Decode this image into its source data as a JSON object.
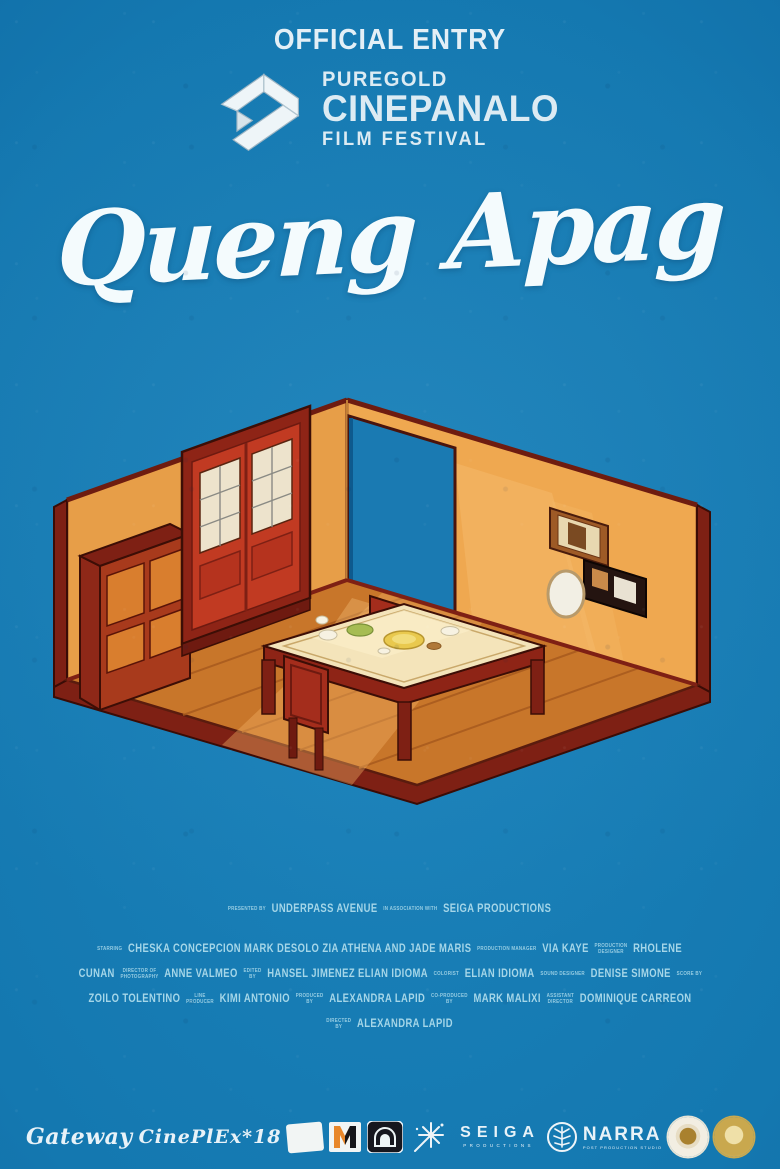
{
  "poster": {
    "official_entry": "OFFICIAL ENTRY",
    "festival": {
      "brand": "PUREGOLD",
      "name": "CINEPANALO",
      "subtitle": "FILM FESTIVAL",
      "icon": "impossible-ribbon-play-icon"
    },
    "title": "Queng Apag",
    "palette": {
      "background_blue": "#1478b0",
      "wall_orange": "#eda44c",
      "floor_wood": "#c8762a",
      "trim_maroon": "#7e2014",
      "door_red": "#c13a22",
      "doorway_blue": "#1a7ab2",
      "headline_text": "#e3eff6",
      "credits_text": "#a5d6e8"
    },
    "illustration_description": "Isometric cutaway dining room: orange walls, wooden plank floor, red double door with white window panes, tall cabinet, dining table set with food, two red chairs, open blue doorway, two wall frames and an oval mirror"
  },
  "credits": {
    "lines": [
      {
        "segments": [
          {
            "role": [
              "PRESENTED BY"
            ]
          },
          {
            "name": "UNDERPASS AVENUE"
          },
          {
            "role": [
              "IN ASSOCIATION WITH"
            ]
          },
          {
            "name": "SEIGA PRODUCTIONS"
          }
        ]
      },
      {
        "segments": [
          {
            "role": [
              "STARRING"
            ]
          },
          {
            "name": "CHESKA CONCEPCION MARK DESOLO ZIA ATHENA AND JADE MARIS"
          },
          {
            "role": [
              "PRODUCTION MANAGER"
            ]
          },
          {
            "name": "VIA KAYE"
          },
          {
            "role": [
              "PRODUCTION",
              "DESIGNER"
            ]
          },
          {
            "name": "RHOLENE"
          }
        ]
      },
      {
        "segments": [
          {
            "name": "CUNAN"
          },
          {
            "role": [
              "DIRECTOR OF",
              "PHOTOGRAPHY"
            ]
          },
          {
            "name": "ANNE VALMEO"
          },
          {
            "role": [
              "EDITED",
              "BY"
            ]
          },
          {
            "name": "HANSEL JIMENEZ ELIAN IDIOMA"
          },
          {
            "role": [
              "COLORIST"
            ]
          },
          {
            "name": "ELIAN IDIOMA"
          },
          {
            "role": [
              "SOUND DESIGNER"
            ]
          },
          {
            "name": "DENISE SIMONE"
          },
          {
            "role": [
              "SCORE BY"
            ]
          }
        ]
      },
      {
        "segments": [
          {
            "name": "ZOILO TOLENTINO"
          },
          {
            "role": [
              "LINE",
              "PRODUCER"
            ]
          },
          {
            "name": "KIMI ANTONIO"
          },
          {
            "role": [
              "PRODUCED",
              "BY"
            ]
          },
          {
            "name": "ALEXANDRA LAPID"
          },
          {
            "role": [
              "CO-PRODUCED",
              "BY"
            ]
          },
          {
            "name": "MARK MALIXI"
          },
          {
            "role": [
              "ASSISTANT",
              "DIRECTOR"
            ]
          },
          {
            "name": "DOMINIQUE CARREON"
          }
        ]
      },
      {
        "segments": [
          {
            "role": [
              "DIRECTED",
              "BY"
            ]
          },
          {
            "name": "ALEXANDRA LAPID"
          }
        ]
      }
    ]
  },
  "footer_logos": {
    "gateway": "Gateway",
    "cineplex": "CinePlEx*18",
    "seiga": {
      "name": "SEIGA",
      "sub": "PRODUCTIONS"
    },
    "narra": {
      "name": "NARRA",
      "sub": "POST PRODUCTION STUDIO"
    }
  }
}
